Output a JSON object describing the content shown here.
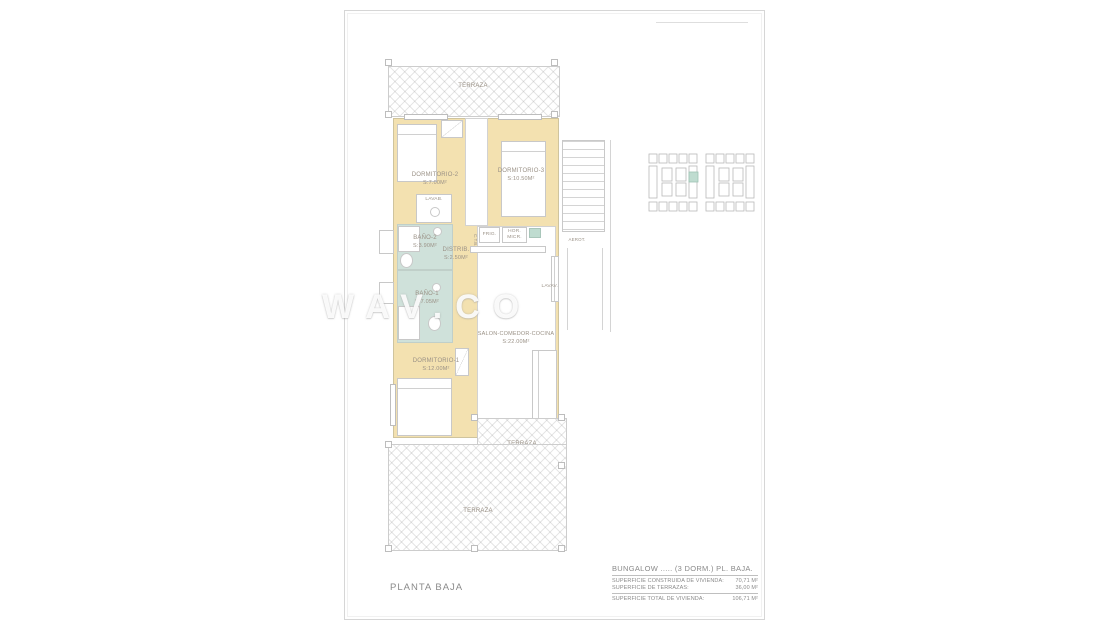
{
  "sheet": {
    "plan_title": "PLANTA BAJA"
  },
  "watermark": {
    "text": "WAV.CO"
  },
  "rooms": {
    "terraza_top": {
      "name": "TERRAZA"
    },
    "dormitorio2": {
      "name": "DORMITORIO-2",
      "area": "S:7.00M²"
    },
    "dormitorio3": {
      "name": "DORMITORIO-3",
      "area": "S:10.50M²"
    },
    "bano2": {
      "name": "BAÑO-2",
      "area": "S:3.90M²"
    },
    "bano1": {
      "name": "BAÑO-1",
      "area": "S:7.05M²"
    },
    "distrib": {
      "name": "DISTRIB.",
      "area": "S:2.50M²"
    },
    "salon": {
      "name": "SALON-COMEDOR-COCINA",
      "area": "S:22.00M²"
    },
    "dormitorio1": {
      "name": "DORMITORIO-1",
      "area": "S:12.00M²"
    },
    "terraza_small": {
      "name": "TERRAZA",
      "area": "S:7.00M²"
    },
    "terraza_big": {
      "name": "TERRAZA"
    }
  },
  "fixtures": {
    "lavabo": "LAVAB.",
    "frigorifico": "FRIG.",
    "horno_line1": "HOR.",
    "horno_line2": "MICR.",
    "aerotermia": "AEROT.",
    "lavavajillas": "LAVAV.",
    "columna": "C.T.B."
  },
  "title_block": {
    "title": "BUNGALOW ..... (3 DORM.)  PL. BAJA.",
    "rows": [
      {
        "label": "SUPERFICIE CONSTRUIDA DE VIVIENDA:",
        "value": "70,71 M²"
      },
      {
        "label": "SUPERFICIE DE TERRAZAS:",
        "value": "36,00 M²"
      },
      {
        "label": "SUPERFICIE TOTAL DE VIVIENDA:",
        "value": "106,71 M²"
      }
    ]
  },
  "colors": {
    "wall_cream": "#f3e1b0",
    "bath_teal": "#cfe1da",
    "accent_teal": "#bfdcd0",
    "label_text": "#9a9186",
    "line_gray": "#c6c6c6"
  }
}
